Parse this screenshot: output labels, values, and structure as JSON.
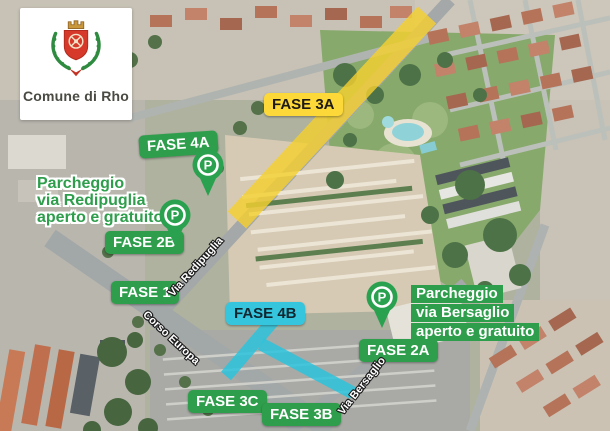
{
  "logo": {
    "text": "Comune di Rho"
  },
  "chips": {
    "fase_3a": "FASE 3A",
    "fase_4a": "FASE 4A",
    "fase_2b": "FASE 2B",
    "fase_1": "FASE 1",
    "fase_4b": "FASE 4B",
    "fase_2a": "FASE 2A",
    "fase_3c": "FASE 3C",
    "fase_3b": "FASE 3B"
  },
  "annotations": {
    "redipuglia": {
      "line1": "Parcheggio",
      "line2": "via Redipuglia",
      "line3": "aperto e gratuito"
    },
    "bersaglio": {
      "line1": "Parcheggio",
      "line2": "via Bersaglio",
      "line3": "aperto e gratuito"
    }
  },
  "streets": {
    "redipuglia": "Via Redipuglia",
    "corso_europa": "Corso Europa",
    "bersaglio": "Via Bersaglio"
  },
  "markers": {
    "letter": "P"
  },
  "colors": {
    "label_green": "#2f9e4c",
    "label_yellow": "#fcd838",
    "label_cyan": "#35c6de",
    "highlight_yellow": "#f4d02f",
    "highlight_cyan": "#2cc3dc",
    "pin_green": "#2aa14f"
  }
}
